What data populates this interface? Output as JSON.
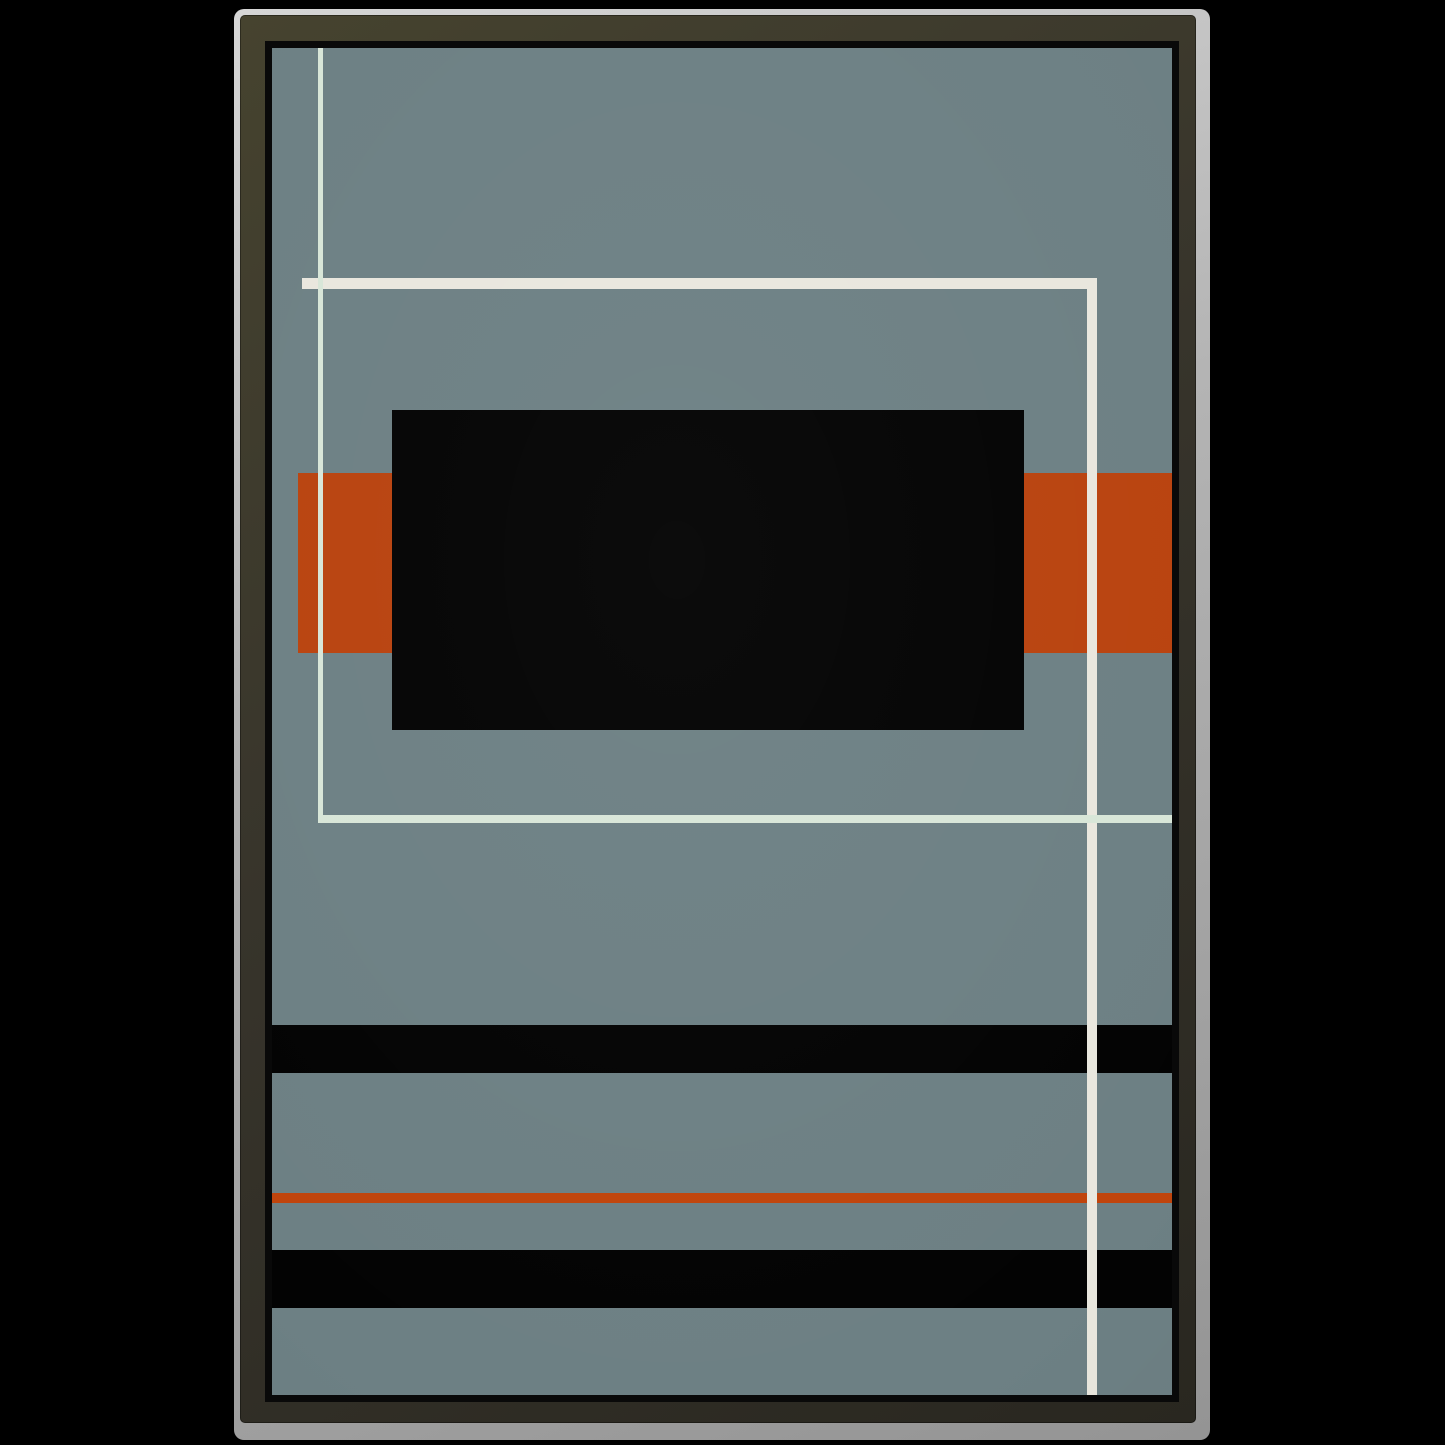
{
  "image": {
    "description": "Framed abstract geometric minimalist poster mockup on black background"
  },
  "palette": {
    "page_background": "#000000",
    "paper_edge_light": "#d6d6d6",
    "paper_edge_dark": "#949494",
    "frame_face_light": "#46432f",
    "frame_face_mid": "#37342b",
    "frame_face_dark": "#292720",
    "frame_inner_lip": "#090909",
    "artwork_background": "#6d8084",
    "art_black": "#030303",
    "art_orange": "#b9430f",
    "art_orange_rule": "#c0440c",
    "art_white_warm": "#e9e7de",
    "art_white_mint": "#d8e6d8"
  },
  "frame": {
    "edge_x": 234,
    "edge_y": 9,
    "edge_width": 976,
    "edge_height": 1431,
    "edge_thickness_top": 6,
    "edge_thickness_left": 6,
    "edge_thickness_right": 14,
    "edge_thickness_bottom": 17
  },
  "artwork": {
    "x": 272,
    "y": 48,
    "width": 900,
    "height": 1347,
    "background": "#6d8084",
    "shapes": [
      {
        "name": "left-orange-bar",
        "color": "#b9430f",
        "x": 26,
        "y": 425,
        "w": 94,
        "h": 180
      },
      {
        "name": "right-orange-bar",
        "color": "#b9430f",
        "x": 752,
        "y": 425,
        "w": 148,
        "h": 180
      },
      {
        "name": "black-rectangle",
        "color": "#030303",
        "x": 120,
        "y": 362,
        "w": 632,
        "h": 320
      },
      {
        "name": "black-stripe-top",
        "color": "#030303",
        "x": 0,
        "y": 977,
        "w": 900,
        "h": 48
      },
      {
        "name": "orange-rule-line",
        "color": "#c0440c",
        "x": 0,
        "y": 1145,
        "w": 900,
        "h": 10
      },
      {
        "name": "black-stripe-bottom",
        "color": "#030303",
        "x": 0,
        "y": 1202,
        "w": 900,
        "h": 58
      },
      {
        "name": "thick-horizontal-line",
        "color": "#e9e7de",
        "x": 30,
        "y": 230,
        "w": 795,
        "h": 11
      },
      {
        "name": "thick-vertical-line",
        "color": "#e9e7de",
        "x": 815,
        "y": 230,
        "w": 10,
        "h": 1117
      },
      {
        "name": "thin-vertical-line",
        "color": "#d8e6d8",
        "x": 46,
        "y": 0,
        "w": 5,
        "h": 775
      },
      {
        "name": "thin-horizontal-line",
        "color": "#d8e6d8",
        "x": 46,
        "y": 767,
        "w": 854,
        "h": 8
      }
    ]
  }
}
